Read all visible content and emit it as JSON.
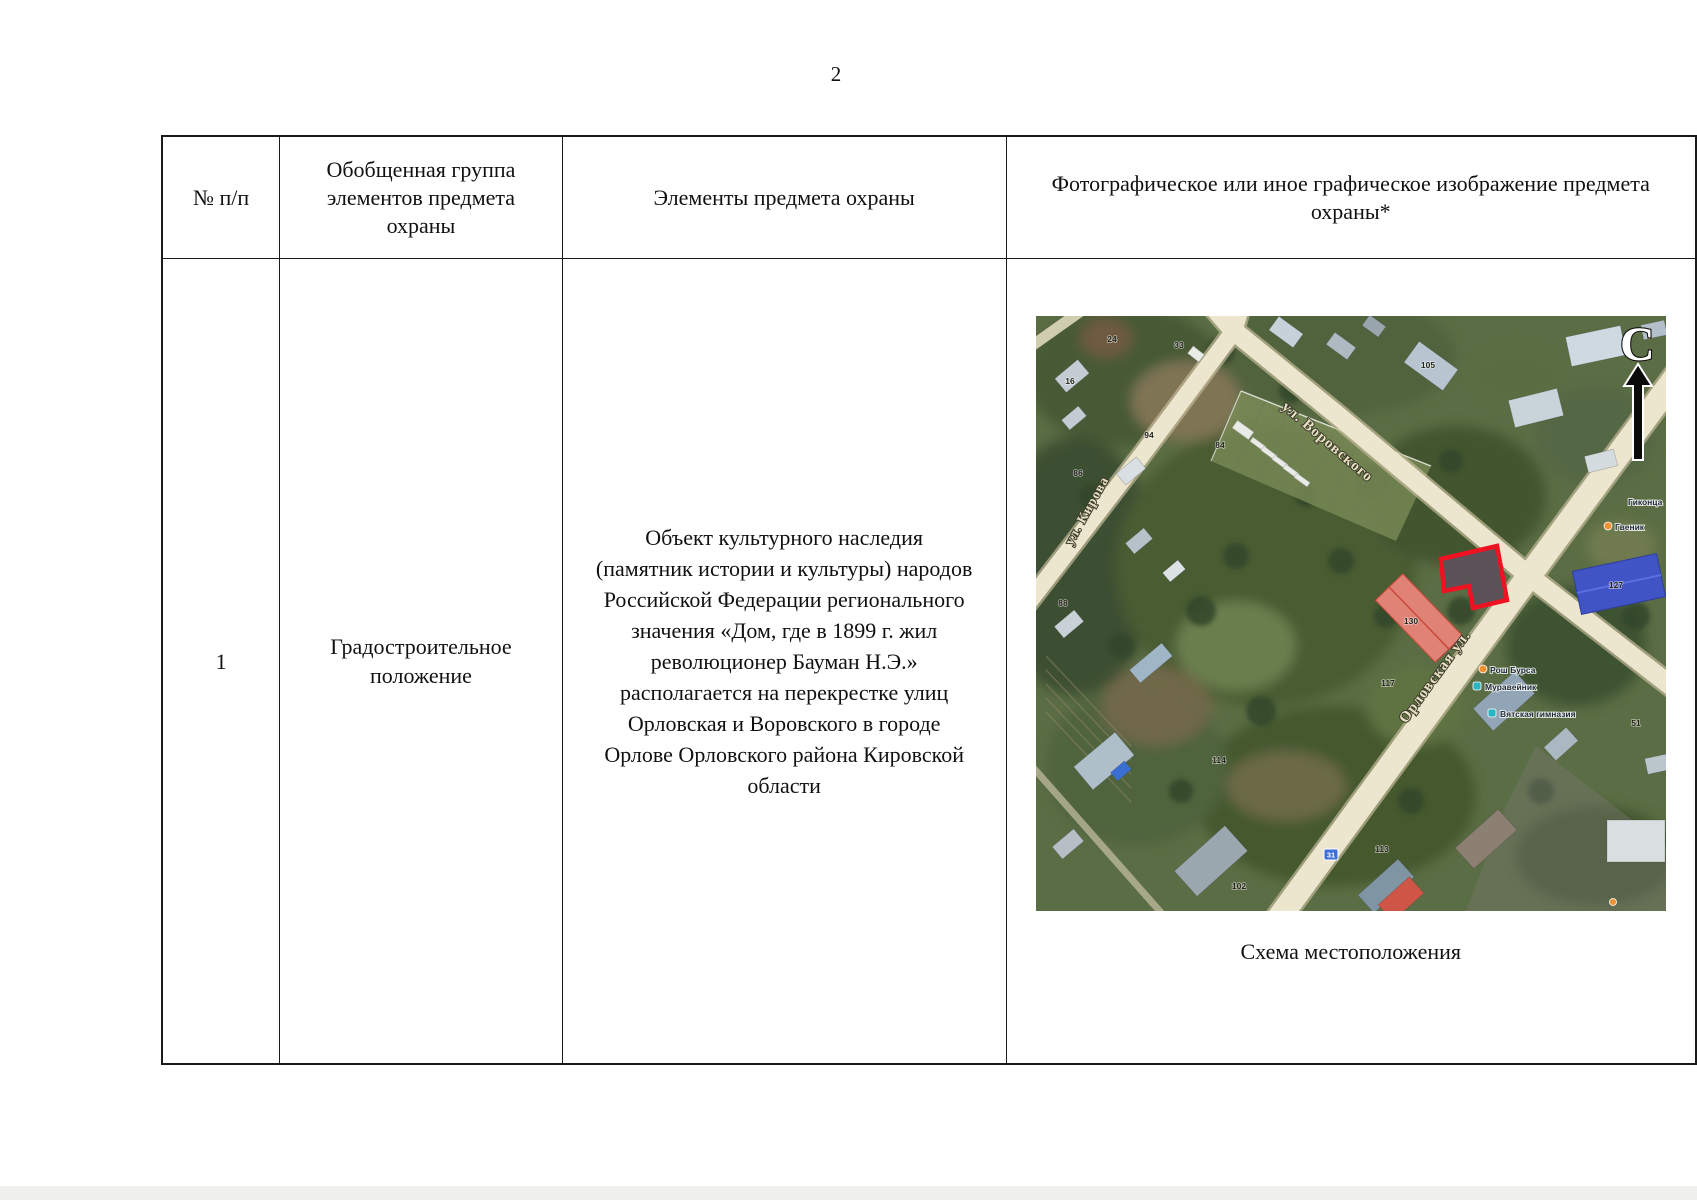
{
  "page": {
    "number": "2"
  },
  "table": {
    "headers": {
      "col1": "№ п/п",
      "col2": "Обобщенная группа элементов предмета охраны",
      "col3": "Элементы предмета охраны",
      "col4": "Фотографическое или иное графическое изображение предмета охраны*"
    },
    "row1": {
      "num": "1",
      "group": "Градостроительное положение",
      "element_lines": [
        "Объект культурного наследия",
        "(памятник истории и культуры) народов",
        "Российской Федерации регионального",
        "значения «Дом, где в 1899 г. жил",
        "революционер Бауман Н.Э.»",
        "располагается на перекрестке улиц",
        "Орловская и Воровского в городе",
        "Орлове Орловского района Кировской",
        "области"
      ],
      "image_caption": "Схема местоположения"
    }
  },
  "map": {
    "north_label": "С",
    "streets": {
      "kirova": "ул. Кирова",
      "vorovskogo": "ул. Воровского",
      "orlovskaya": "Орловская ул."
    },
    "numbers": [
      "24",
      "16",
      "33",
      "105",
      "84",
      "86",
      "88",
      "94",
      "127",
      "130",
      "117",
      "113",
      "102",
      "114",
      "51"
    ],
    "road_sign": "31",
    "pois": [
      {
        "label": "Гиконца"
      },
      {
        "label": "Гвеник"
      },
      {
        "label": "Рош Бурса"
      },
      {
        "label": "Муравейник"
      },
      {
        "label": "Вятская гимназия"
      }
    ],
    "colors": {
      "object_outline": "#ee1222",
      "road": "#ede6ce",
      "poi_orange": "#ef9234",
      "poi_teal": "#2ab5c3"
    }
  }
}
